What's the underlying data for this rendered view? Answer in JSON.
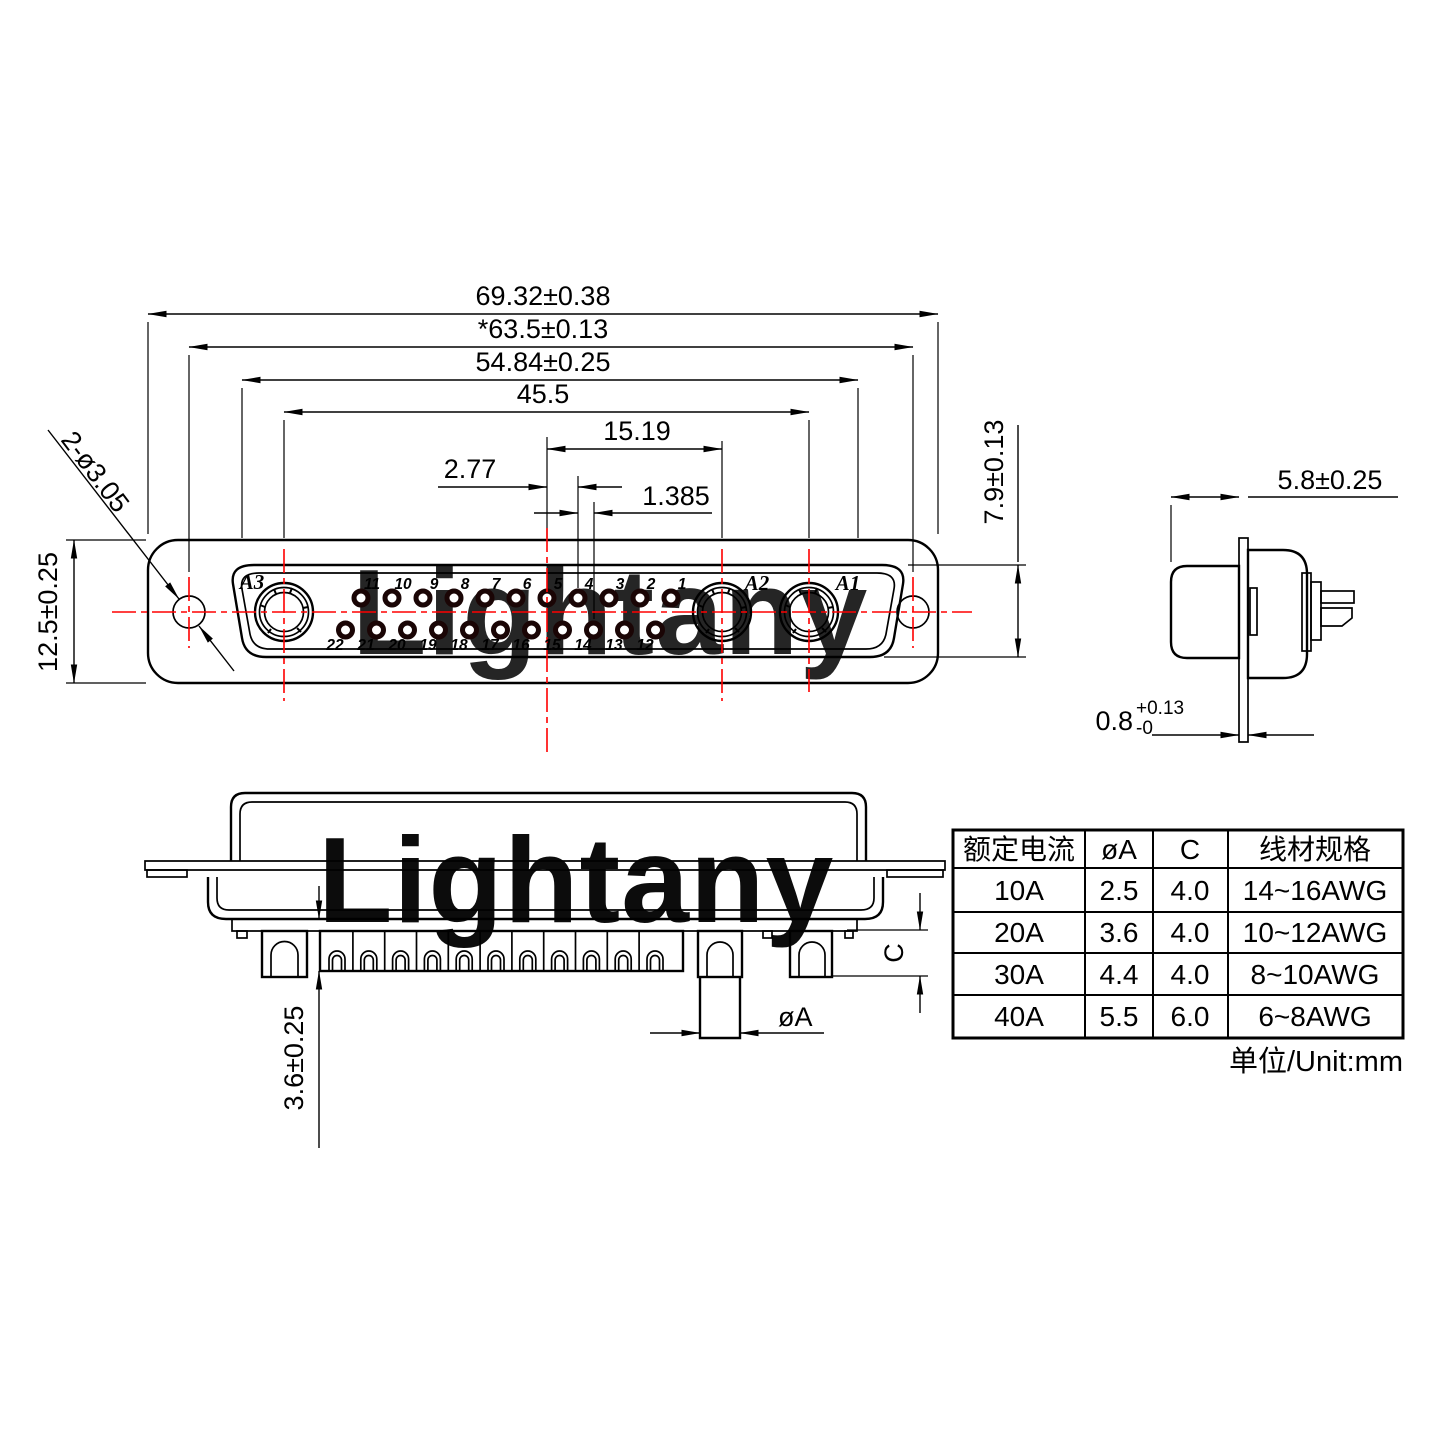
{
  "watermark": {
    "text": "Lightany",
    "color": "#f5d2d2"
  },
  "front_view": {
    "dim_width_outer": "69.32±0.38",
    "dim_hole_span": "*63.5±0.13",
    "dim_shell_width": "54.84±0.25",
    "dim_contact_span": "45.5",
    "dim_center_to_a2": "15.19",
    "dim_pin_pitch": "2.77",
    "dim_row_offset": "1.385",
    "dim_insert_height": "7.9±0.13",
    "dim_flange_height": "12.5±0.25",
    "dim_mounting_holes": "2-ø3.05",
    "contact_a1": "A1",
    "contact_a2": "A2",
    "contact_a3": "A3",
    "pins_top": [
      "11",
      "10",
      "9",
      "8",
      "7",
      "6",
      "5",
      "4",
      "3",
      "2",
      "1"
    ],
    "pins_bottom": [
      "22",
      "21",
      "20",
      "19",
      "18",
      "17",
      "16",
      "15",
      "14",
      "13",
      "12"
    ]
  },
  "side_view": {
    "dim_shell_depth": "5.8±0.25",
    "dim_flange_thickness": "0.8",
    "tol_plus": "+0.13",
    "tol_minus": "-0"
  },
  "bottom_view": {
    "dim_tail": "3.6±0.25",
    "dim_pin_dia": "øA",
    "dim_cup_depth": "C"
  },
  "spec_table": {
    "headers": [
      "额定电流",
      "øA",
      "C",
      "线材规格"
    ],
    "rows": [
      [
        "10A",
        "2.5",
        "4.0",
        "14~16AWG"
      ],
      [
        "20A",
        "3.6",
        "4.0",
        "10~12AWG"
      ],
      [
        "30A",
        "4.4",
        "4.0",
        "8~10AWG"
      ],
      [
        "40A",
        "5.5",
        "6.0",
        "6~8AWG"
      ]
    ],
    "unit_note": "单位/Unit:mm"
  },
  "colors": {
    "line": "#000000",
    "accent": "#ff0000",
    "watermark": "#f5d2d2"
  }
}
